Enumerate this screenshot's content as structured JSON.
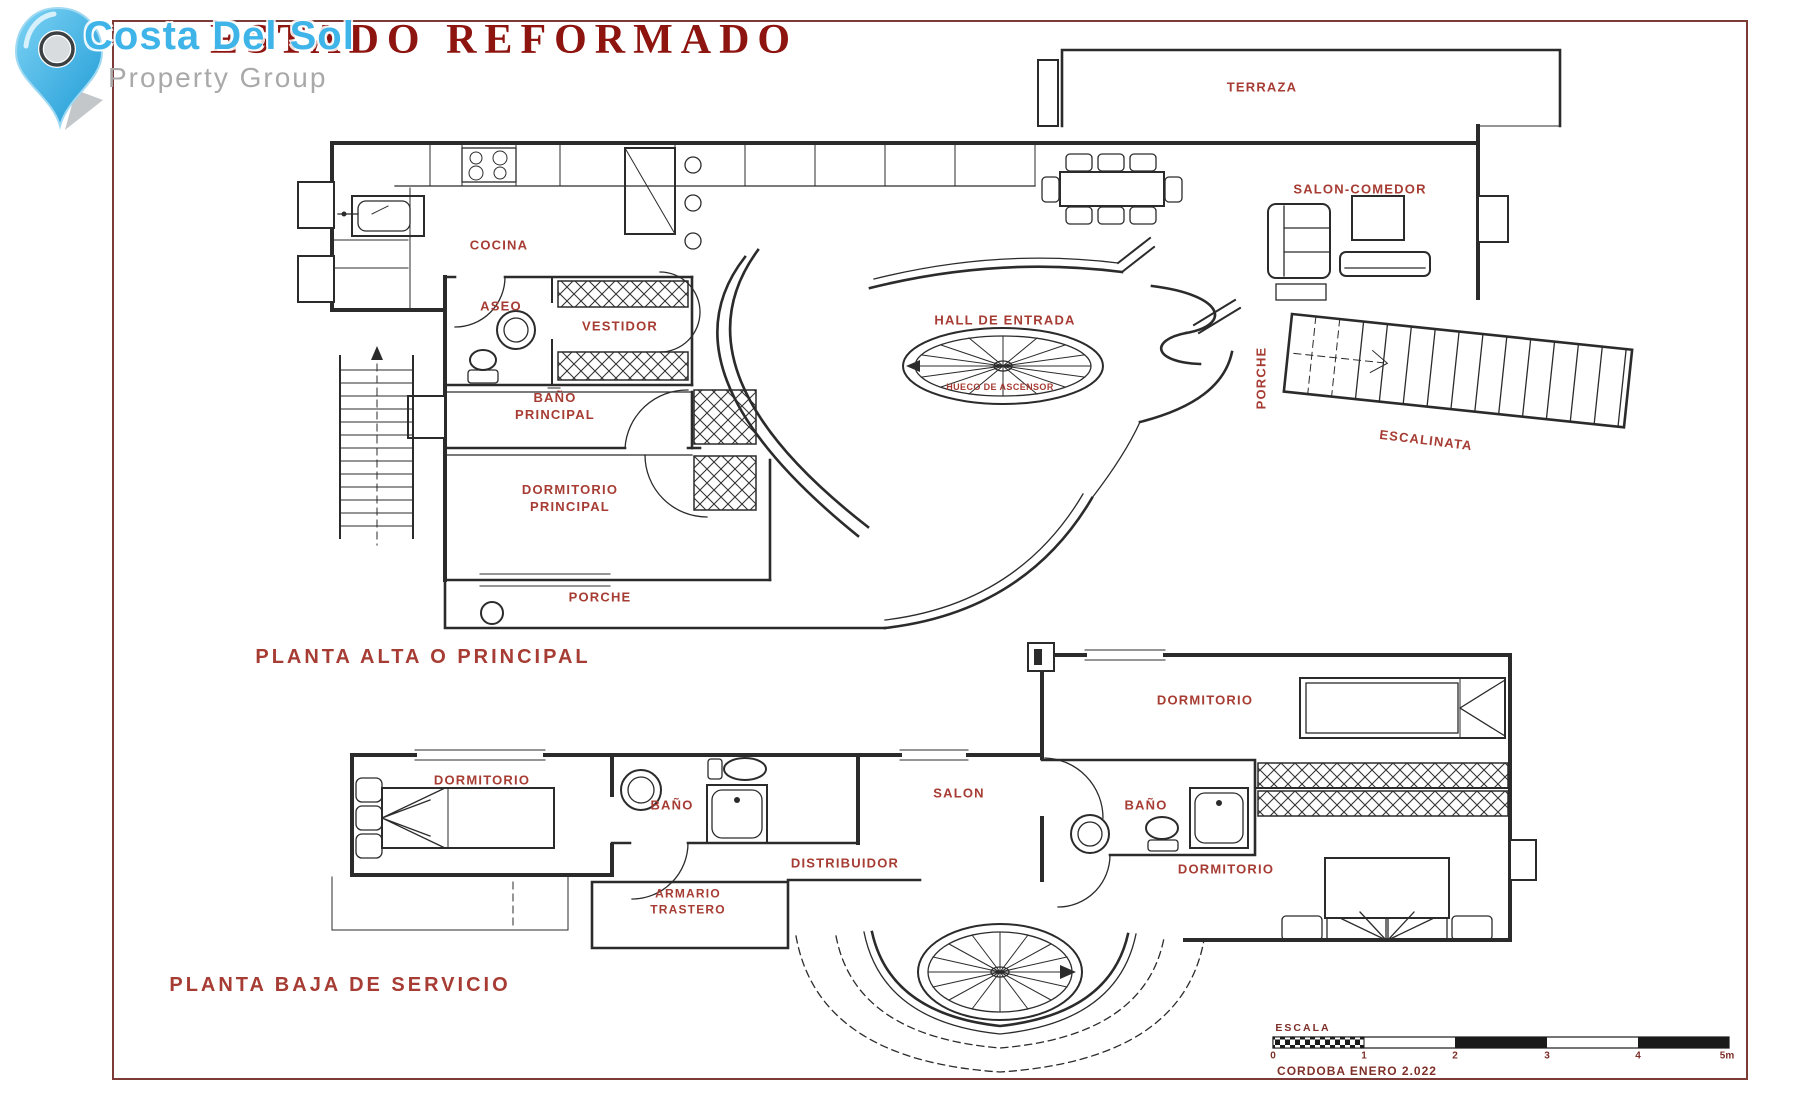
{
  "header": {
    "title": "ESTADO REFORMADO",
    "logo": {
      "name": "Costa Del Sol",
      "tagline": "Property Group"
    }
  },
  "upper_plan": {
    "title": "PLANTA ALTA O PRINCIPAL",
    "labels": {
      "terraza": "TERRAZA",
      "salon_comedor": "SALON-COMEDOR",
      "cocina": "COCINA",
      "aseo": "ASEO",
      "vestidor": "VESTIDOR",
      "hall": "HALL DE ENTRADA",
      "hueco_ascensor": "HUECO DE ASCENSOR",
      "bano_principal": "BAÑO\nPRINCIPAL",
      "dormitorio_principal": "DORMITORIO\nPRINCIPAL",
      "porche": "PORCHE",
      "porche_lateral": "PORCHE",
      "escalinata": "ESCALINATA"
    }
  },
  "lower_plan": {
    "title": "PLANTA BAJA DE SERVICIO",
    "labels": {
      "dormitorio_izq": "DORMITORIO",
      "bano_izq": "BAÑO",
      "salon": "SALON",
      "distribuidor": "DISTRIBUIDOR",
      "bano_der": "BAÑO",
      "dormitorio_sup": "DORMITORIO",
      "dormitorio_inf": "DORMITORIO",
      "armario": "ARMARIO\nTRASTERO"
    }
  },
  "scale_bar": {
    "label": "ESCALA",
    "ticks": [
      "0",
      "1",
      "2",
      "3",
      "4",
      "5m"
    ],
    "note": "CORDOBA ENERO 2.022"
  },
  "colors": {
    "label_red": "#a63c33",
    "title_red": "#8e1410",
    "scale_red": "#7d2f28",
    "frame": "#7d3b37",
    "wall": "#2b2b2b",
    "logo_blue": "#3fb4e9",
    "logo_gray": "#a9a9a9"
  }
}
